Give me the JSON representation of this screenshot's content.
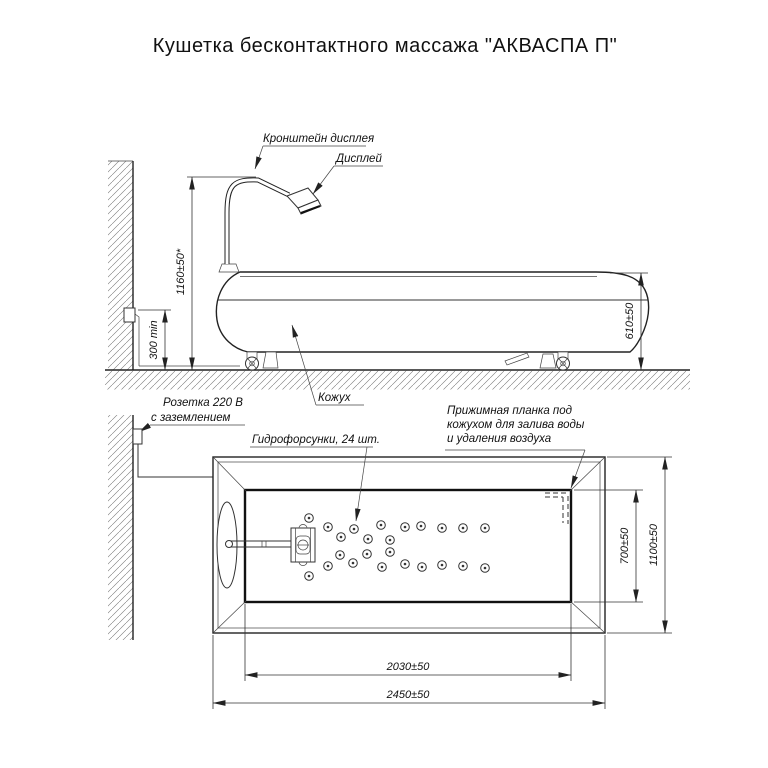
{
  "title": "Кушетка бесконтактного массажа \"АКВАСПА П\"",
  "side_view": {
    "labels": {
      "display_bracket": "Кронштейн дисплея",
      "display": "Дисплей",
      "cover": "Кожух",
      "socket_line1": "Розетка 220 В",
      "socket_line2": "с заземлением"
    },
    "dims": {
      "bracket_height": "1160±50*",
      "socket_height": "300 min",
      "couch_height": "610±50"
    }
  },
  "top_view": {
    "labels": {
      "nozzles": "Гидрофорсунки, 24 шт.",
      "clamp_line1": "Прижимная планка под",
      "clamp_line2": "кожухом для залива воды",
      "clamp_line3": "и удаления воздуха"
    },
    "dims": {
      "basin_width": "700±50",
      "overall_width": "1100±50",
      "basin_length": "2030±50",
      "overall_length": "2450±50"
    },
    "nozzle_count": 24
  }
}
